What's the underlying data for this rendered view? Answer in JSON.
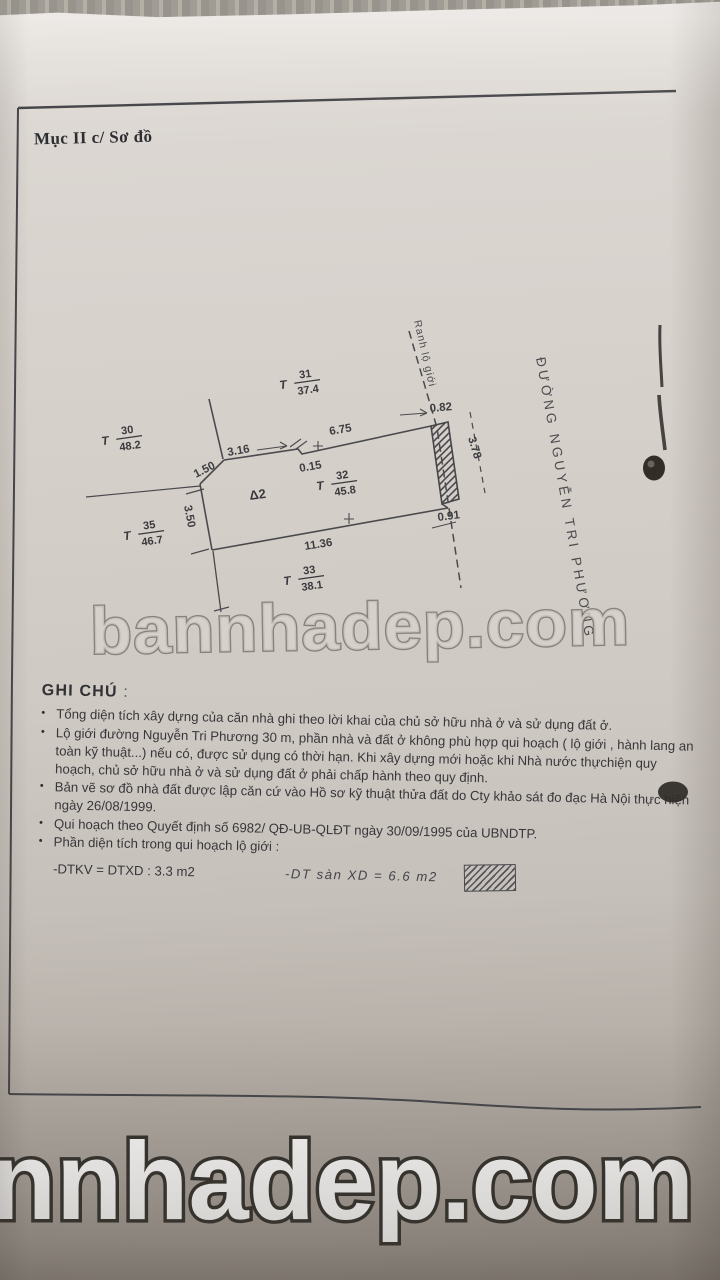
{
  "document": {
    "section_label": "Mục II c/ Sơ đồ",
    "notes": {
      "heading": "GHI CHÚ",
      "heading_colon": ":",
      "bullets": [
        "Tổng diện tích xây dựng của căn nhà ghi theo lời khai của chủ sở hữu nhà ở và sử dụng đất ở.",
        "Lộ giới đường Nguyễn Tri Phương 30 m, phần nhà và đất ở không phù hợp qui hoạch ( lộ giới , hành lang an toàn kỹ thuật...) nếu có, được sử dụng có thời hạn. Khi xây dựng mới hoặc khi Nhà nước thựchiện quy hoạch, chủ sở hữu nhà ở và sử dụng đất ở phải chấp hành theo quy định.",
        "Bản vẽ sơ đồ nhà đất được lập căn cứ vào Hồ sơ kỹ thuật thửa đất do Cty khảo sát đo đạc Hà Nội thực hiện ngày 26/08/1999.",
        "Qui hoạch theo Quyết định số 6982/ QĐ-UB-QLĐT ngày 30/09/1995 của UBNDTP.",
        "Phần diện tích trong qui hoạch lộ giới :"
      ],
      "area_line_left": "-DTKV = DTXD : 3.3 m2",
      "area_line_right": "-DT sàn XD = 6.6 m2"
    }
  },
  "diagram": {
    "street_name": "ĐƯỜNG NGUYỄN TRI PHƯƠNG",
    "boundary_label": "Ranh lộ giới",
    "subplot_label": "Δ2",
    "parcel_prefix": "T",
    "parcels": {
      "t30": {
        "no": "30",
        "area": "48.2"
      },
      "t31": {
        "no": "31",
        "area": "37.4"
      },
      "t32": {
        "no": "32",
        "area": "45.8"
      },
      "t33": {
        "no": "33",
        "area": "38.1"
      },
      "t35": {
        "no": "35",
        "area": "46.7"
      }
    },
    "dims": {
      "d150": "1.50",
      "d316": "3.16",
      "d015": "0.15",
      "d675": "6.75",
      "d082": "0.82",
      "d378": "3.78",
      "d091": "0.91",
      "d350": "3.50",
      "d1136": "11.36"
    }
  },
  "watermarks": {
    "middle": "bannhadep.com",
    "bottom": "nnhadep.com"
  },
  "colors": {
    "paper": "#d2ccc6",
    "ink": "#37373b",
    "line": "#4a4a4e"
  }
}
